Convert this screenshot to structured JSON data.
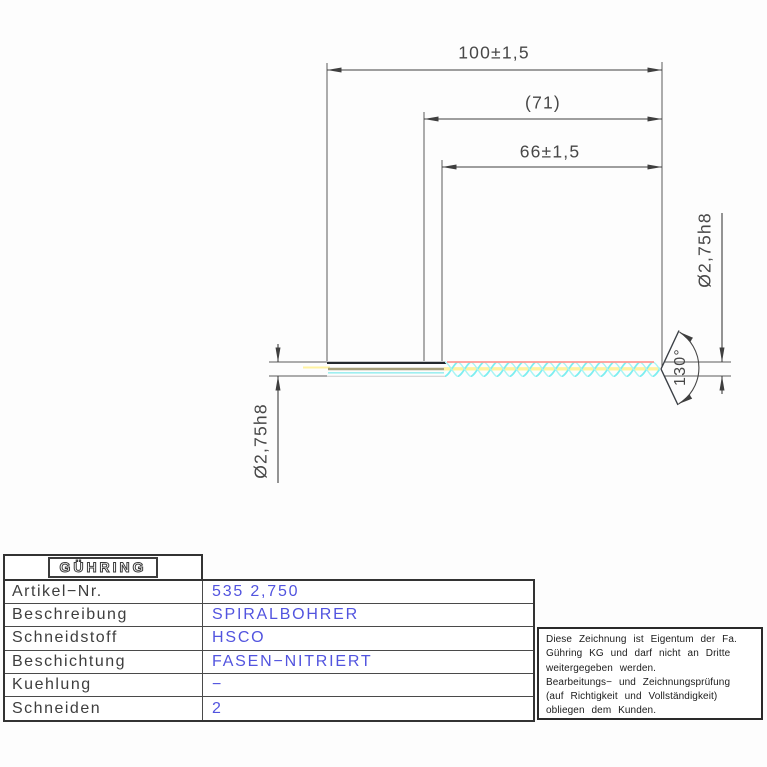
{
  "drawing": {
    "dimensions": {
      "overall_length": "100±1,5",
      "flute_length_ref": "(71)",
      "flute_length": "66±1,5",
      "diameter_left": "Ø2,75h8",
      "diameter_right": "Ø2,75h8",
      "point_angle": "130°"
    },
    "colors": {
      "flute_hatch_cyan": "#7deef0",
      "flute_hatch_cyan_light": "#a9f4f4",
      "center_line_yellow": "#fff2a1",
      "margin_edge_red": "#ff9a94",
      "shank_core_olive": "#a49e7b",
      "outline_dark": "#23282e",
      "dimension_gray": "#474747",
      "value_text_blue": "#5254df"
    }
  },
  "title_block": {
    "logo": "GÜHRING",
    "rows": [
      {
        "label": "Artikel−Nr.",
        "value": "535 2,750"
      },
      {
        "label": "Beschreibung",
        "value": "SPIRALBOHRER"
      },
      {
        "label": "Schneidstoff",
        "value": "HSCO"
      },
      {
        "label": "Beschichtung",
        "value": "FASEN−NITRIERT"
      },
      {
        "label": "Kuehlung",
        "value": "−"
      },
      {
        "label": "Schneiden",
        "value": "2"
      }
    ]
  },
  "note": {
    "lines": [
      "Diese Zeichnung ist Eigentum der Fa.",
      "Gühring KG und darf nicht an Dritte",
      "weitergegeben werden.",
      "Bearbeitungs− und Zeichnungsprüfung",
      "(auf Richtigkeit und Vollständigkeit)",
      "obliegen dem Kunden."
    ]
  }
}
